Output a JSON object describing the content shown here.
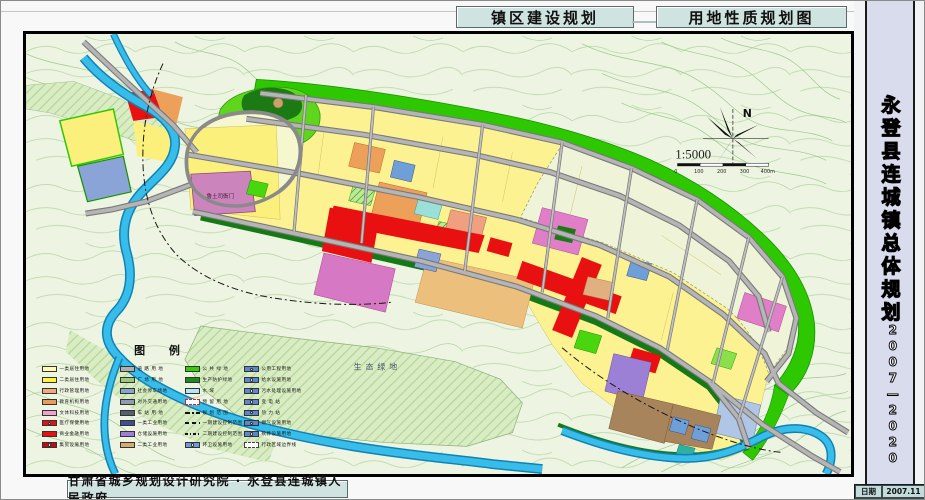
{
  "header": {
    "tab1": "镇区建设规划",
    "tab2": "用地性质规划图"
  },
  "sidebar": {
    "title": "永登县连城镇总体规划",
    "years": "2007—2020",
    "date_label": "日期",
    "date_value": "2007.11",
    "sheet_label": "图号",
    "sheet_value": "08"
  },
  "footer": {
    "credit": "甘肃省城乡规划设计研究院 · 永登县连城镇人民政府"
  },
  "map": {
    "labels": {
      "eco": "生态绿地",
      "yamen": "鲁土司衙门"
    },
    "compass_n": "N",
    "scale_text": "1:5000",
    "scale_ticks": [
      "0",
      "100",
      "200",
      "300",
      "400m"
    ],
    "colors": {
      "water": "#38bdea",
      "green_belt": "#2ec800",
      "road": "#b5b5b5",
      "residential": "#fcf292",
      "commercial_red": "#e81010",
      "panel": "#cfe3e1"
    },
    "legend": {
      "title": "图  例",
      "columns": [
        {
          "items": [
            {
              "label": "一类居住用地",
              "color": "#fffbb0",
              "style": "solid"
            },
            {
              "label": "二类居住用地",
              "color": "#fff341",
              "style": "solid"
            },
            {
              "label": "行政管理用地",
              "color": "#f2a97e",
              "style": "solid"
            },
            {
              "label": "教育机构用地",
              "color": "#e89b5a",
              "style": "solid"
            },
            {
              "label": "文体科技用地",
              "color": "#f0a2ca",
              "style": "solid"
            },
            {
              "label": "医疗保健用地",
              "color": "#e81010",
              "style": "cross"
            },
            {
              "label": "商业金融用地",
              "color": "#e81010",
              "style": "solid"
            },
            {
              "label": "集贸设施用地",
              "color": "#c40a0a",
              "style": "cross"
            }
          ]
        },
        {
          "items": [
            {
              "label": "道 路 用 地",
              "color": "#aeaeae",
              "style": "solid"
            },
            {
              "label": "广 场 用 地",
              "color": "#9cc87e",
              "style": "solid"
            },
            {
              "label": "社会停车场地",
              "color": "#86a8c8",
              "style": "solid"
            },
            {
              "label": "对外交通用地",
              "color": "#8e9cb0",
              "style": "solid"
            },
            {
              "label": "车 站 用 地",
              "color": "#55616e",
              "style": "solid"
            },
            {
              "label": "一类工业用地",
              "color": "#39518e",
              "style": "solid"
            },
            {
              "label": "仓储设施用地",
              "color": "#9c80d6",
              "style": "solid"
            },
            {
              "label": "二类工业用地",
              "color": "#d9aa6e",
              "style": "solid"
            }
          ]
        },
        {
          "items": [
            {
              "label": "公 共 绿 地",
              "color": "#35cc08",
              "style": "solid"
            },
            {
              "label": "生产防护绿地",
              "color": "#1d8a1d",
              "style": "solid"
            },
            {
              "label": "水    域",
              "color": "#b5e6f5",
              "style": "solid"
            },
            {
              "label": "预 留 用 地",
              "color": "#ffffff",
              "style": "dashred"
            },
            {
              "label": "规 划 范 围",
              "color": "#111111",
              "style": "dash2"
            },
            {
              "label": "一期建设控制范围",
              "color": "#111111",
              "style": "dash1"
            },
            {
              "label": "二期建设控制范围",
              "color": "#111111",
              "style": "dash3"
            },
            {
              "label": "环卫设施用地",
              "color": "#6f9ad8",
              "style": "sym"
            }
          ]
        },
        {
          "items": [
            {
              "label": "公用工程用地",
              "color": "#5b87cc",
              "style": "sym"
            },
            {
              "label": "给水设施用地",
              "color": "#5b87cc",
              "style": "sym"
            },
            {
              "label": "污水处理设施用地",
              "color": "#5b87cc",
              "style": "sym"
            },
            {
              "label": "变  电  站",
              "color": "#5b87cc",
              "style": "sym"
            },
            {
              "label": "热  力  站",
              "color": "#5b87cc",
              "style": "sym"
            },
            {
              "label": "燃气设施用地",
              "color": "#5b87cc",
              "style": "sym"
            },
            {
              "label": "殡葬设施用地",
              "color": "#5b87cc",
              "style": "sym"
            },
            {
              "label": "行政区域边界线",
              "color": "#ffffff",
              "style": "dashbox"
            }
          ]
        }
      ]
    }
  }
}
